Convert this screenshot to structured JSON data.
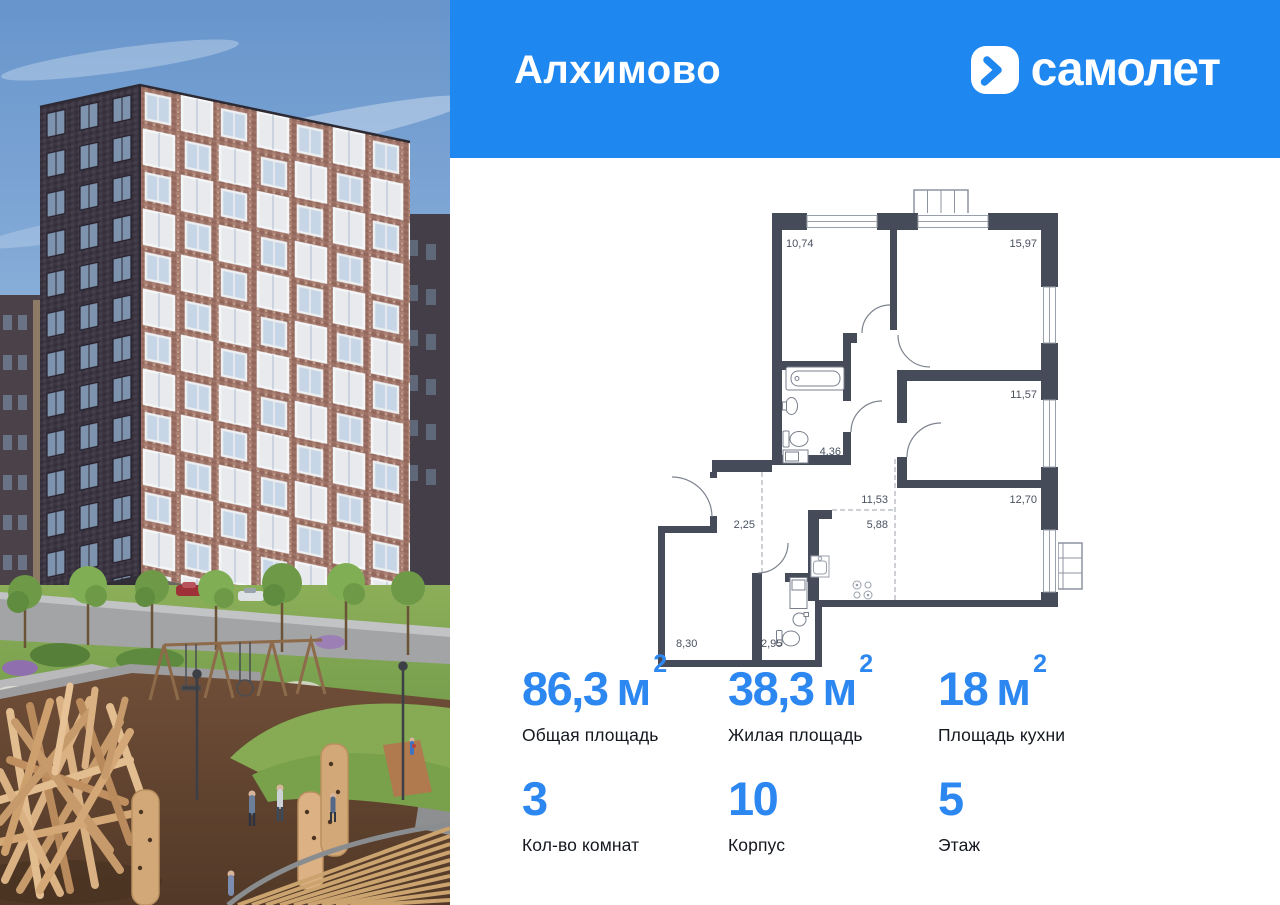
{
  "header": {
    "project_name": "Алхимово",
    "brand": "самолет",
    "bg_color": "#1f87f0"
  },
  "plan": {
    "wall_color": "#454b58",
    "label_color": "#4a5160",
    "rooms": [
      {
        "name": "bedroom-1",
        "area": "10,74"
      },
      {
        "name": "bedroom-2",
        "area": "15,97"
      },
      {
        "name": "bedroom-3",
        "area": "11,57"
      },
      {
        "name": "living-room",
        "area": "12,70"
      },
      {
        "name": "corridor",
        "area": "11,53"
      },
      {
        "name": "kitchen-zone",
        "area": "5,88"
      },
      {
        "name": "bathroom",
        "area": "4,36"
      },
      {
        "name": "hall",
        "area": "2,25"
      },
      {
        "name": "room-4",
        "area": "8,30"
      },
      {
        "name": "wc",
        "area": "2,95"
      }
    ]
  },
  "stats": {
    "value_color": "#2d87f0",
    "label_color": "#14181f",
    "row1": [
      {
        "value": "86,3",
        "unit": "м",
        "sup": "2",
        "label": "Общая площадь"
      },
      {
        "value": "38,3",
        "unit": "м",
        "sup": "2",
        "label": "Жилая площадь"
      },
      {
        "value": "18",
        "unit": "м",
        "sup": "2",
        "label": "Площадь кухни"
      }
    ],
    "row2": [
      {
        "value": "3",
        "label": "Кол-во комнат"
      },
      {
        "value": "10",
        "label": "Корпус"
      },
      {
        "value": "5",
        "label": "Этаж"
      }
    ]
  }
}
